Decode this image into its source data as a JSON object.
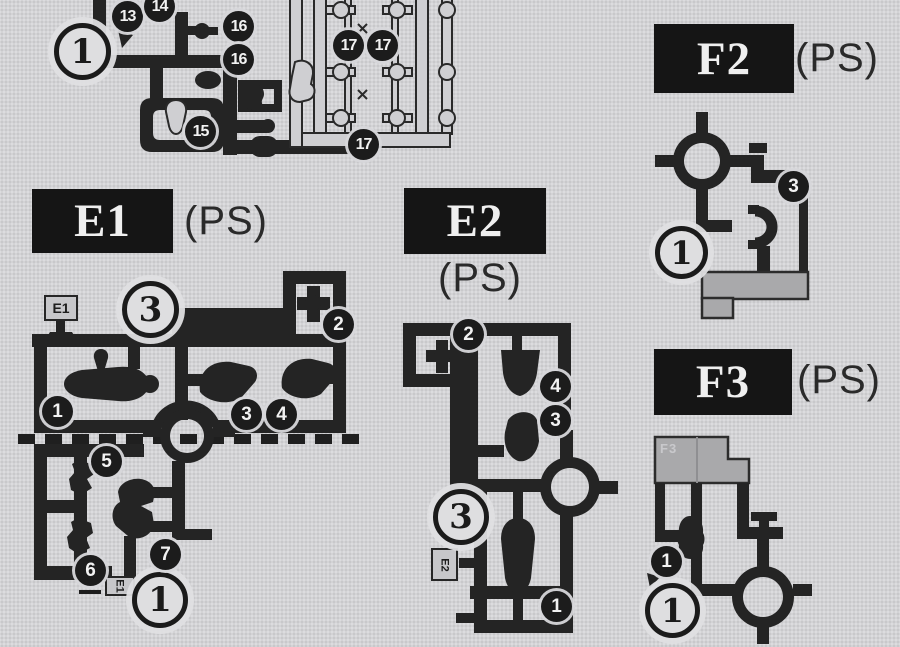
{
  "document": {
    "kind": "model-kit-instruction-runner-chart"
  },
  "colors": {
    "paper": "#d3d3d5",
    "ink": "#242424",
    "plate_bg": "#151515",
    "plate_text": "#efefef",
    "gray_part": "#a9a9ab"
  },
  "sections": {
    "d": {
      "gate": "1",
      "badges": [
        "13",
        "14",
        "16",
        "16",
        "17",
        "17",
        "15",
        "17"
      ]
    },
    "e1": {
      "label": "E1",
      "material": "(PS)",
      "tag_top": "E1",
      "tag_bottom": "E1",
      "gate_top": "3",
      "gate_bottom": "1",
      "badges_top": [
        "2",
        "1",
        "3",
        "4"
      ],
      "badges_bottom": [
        "5",
        "7",
        "6"
      ]
    },
    "e2": {
      "label": "E2",
      "material": "(PS)",
      "tag": "E2",
      "gate": "3",
      "badges": [
        "2",
        "4",
        "3",
        "1"
      ]
    },
    "f2": {
      "label": "F2",
      "material": "(PS)",
      "gate": "1",
      "badges": [
        "3"
      ]
    },
    "f3": {
      "label": "F3",
      "material": "(PS)",
      "block_tag": "F3",
      "gate": "1",
      "badges": [
        "1"
      ]
    }
  }
}
